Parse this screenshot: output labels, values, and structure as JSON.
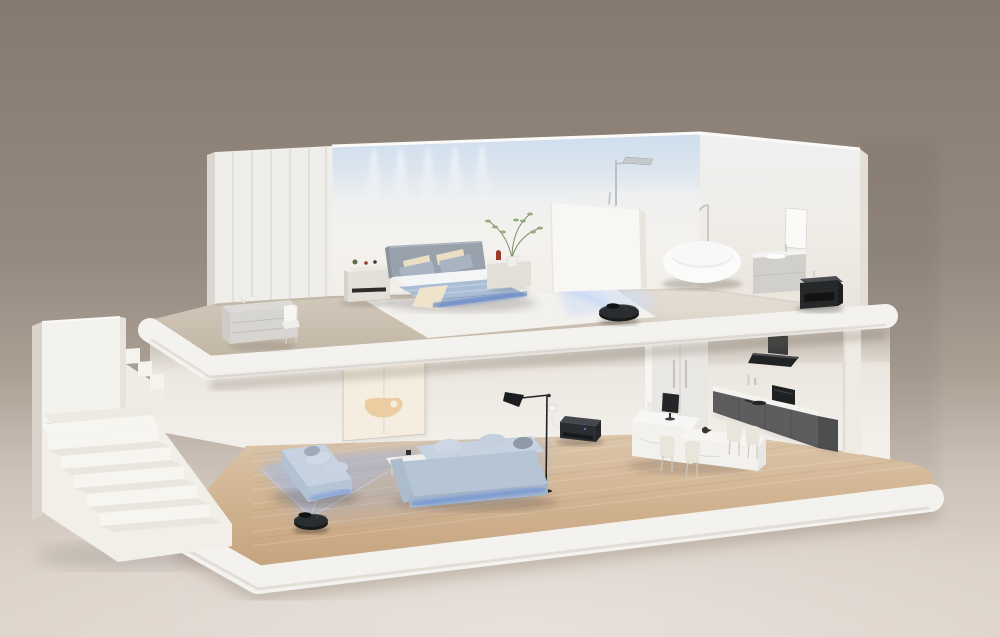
{
  "scene": {
    "type": "3d-render",
    "description": "Isometric cutaway render of a two-story minimalist smart home with robot vacuums cleaning both floors",
    "objects": [
      "staircase",
      "wardrobe-panel-wall",
      "bedroom-bed",
      "bedside-dresser",
      "bedside-table",
      "desk",
      "desk-chair",
      "ceiling-downlights",
      "potted-plant",
      "shower-partition",
      "shower-fixture",
      "bathtub",
      "tub-faucet",
      "wall-mirror",
      "bathroom-vanity",
      "dark-side-cabinet",
      "robot-vacuum-upper",
      "lidar-beams-upper",
      "wall-art",
      "floor-lamp",
      "power-outlet",
      "dock-station",
      "loveseat-sofa",
      "long-sofa",
      "console-table",
      "robot-vacuum-lower",
      "lidar-beams-lower",
      "dining-island",
      "dining-table",
      "dining-chairs",
      "desktop-monitor",
      "bird-ornament",
      "kitchen-cabinets",
      "range-hood",
      "built-in-oven",
      "fridge-recess",
      "wood-floor",
      "area-rug"
    ],
    "colors": {
      "background_top": "#877b71",
      "background_mid": "#9a8e84",
      "ground": "#d9cfc6",
      "wall": "#f3f0eb",
      "wardrobe": "#f0eeea",
      "partition": "#f8f7f4",
      "slab": "#f3f2ef",
      "stair": "#f4f2ed",
      "upper_floor": "#c8bdae",
      "wood_light": "#dcc6ab",
      "wood_dark": "#c6a47f",
      "rug": "#f4f3f0",
      "bed_headboard": "#99a2ac",
      "bed_sheet": "#f4f5f6",
      "bed_duvet": "#a9bdd4",
      "pillow_gray": "#a8b4c1",
      "pillow_cream": "#eadfc4",
      "throw_cream": "#efe4cb",
      "sofa": "#b6c5d5",
      "sofa_top": "#c6d2e0",
      "sofa_front": "#a5b6c9",
      "robot": "#2a2d30",
      "dock": "#2b2e31",
      "underglow": "#4f7de0",
      "glow_blue": "#7fa8ee",
      "kitchen_cabinet": "#5d5d5f",
      "hood": "#202224",
      "counter": "#f4f3f0",
      "marble": "#f2f1ee",
      "chair_cream": "#e9e5db",
      "art_canvas": "#f5eee0",
      "art_blob": "#e9c795",
      "tub": "#fbfbfa",
      "vanity": "#d0cfcc",
      "dark_cabinet": "#26282a",
      "chrome": "#bcbfc3",
      "plant_green": "#94ab7e",
      "accent_red": "#9c3a28"
    }
  }
}
